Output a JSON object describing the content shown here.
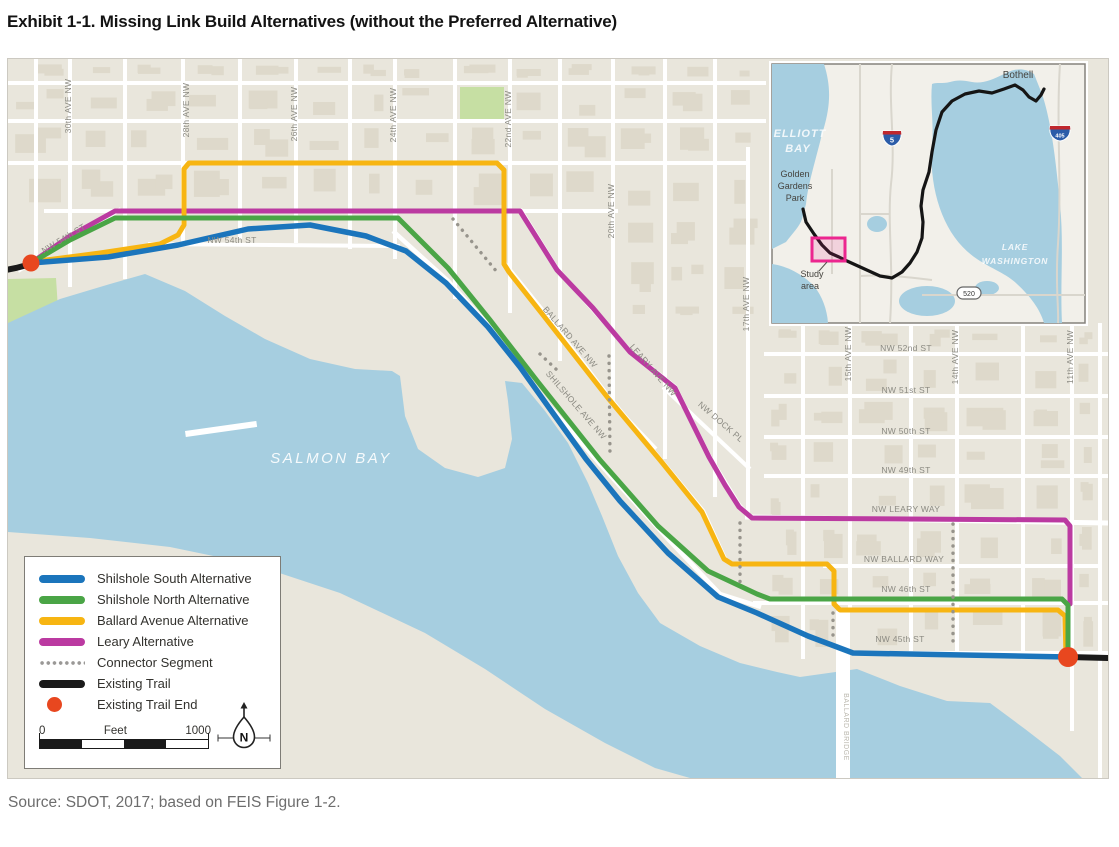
{
  "title": "Exhibit 1-1. Missing Link Build Alternatives (without the Preferred Alternative)",
  "source": "Source: SDOT, 2017; based on FEIS Figure 1-2.",
  "north_label": "N",
  "scale_bar": {
    "start": "0",
    "unit": "Feet",
    "end": "1000"
  },
  "legend": {
    "items": [
      {
        "label": "Shilshole South Alternative",
        "swatch": "line",
        "color": "#1b75bc"
      },
      {
        "label": "Shilshole North Alternative",
        "swatch": "line",
        "color": "#4aa546"
      },
      {
        "label": "Ballard Avenue Alternative",
        "swatch": "line",
        "color": "#f7b512"
      },
      {
        "label": "Leary Alternative",
        "swatch": "line",
        "color": "#bb3aa1"
      },
      {
        "label": "Connector Segment",
        "swatch": "dotted",
        "color": "#9a9896"
      },
      {
        "label": "Existing Trail",
        "swatch": "line",
        "color": "#1a1a1a"
      },
      {
        "label": "Existing Trail End",
        "swatch": "dot",
        "color": "#e8471f"
      }
    ]
  },
  "colors": {
    "water": "#a6cee0",
    "land": "#e9e6dc",
    "street": "#ffffff",
    "park": "#c6dfa3",
    "study_area_pink": "#ec268f",
    "route_blue": "#1b75bc",
    "route_green": "#4aa546",
    "route_yellow": "#f7b512",
    "route_magenta": "#bb3aa1",
    "trail_black": "#1a1a1a",
    "trail_end_red": "#e8471f"
  },
  "map": {
    "street_labels": [
      {
        "text": "30th AVE NW",
        "x": 63,
        "y": 47,
        "rot": -90
      },
      {
        "text": "28th AVE NW",
        "x": 181,
        "y": 51,
        "rot": -90
      },
      {
        "text": "26th AVE NW",
        "x": 289,
        "y": 55,
        "rot": -90
      },
      {
        "text": "24th AVE NW",
        "x": 388,
        "y": 56,
        "rot": -90
      },
      {
        "text": "22nd AVE NW",
        "x": 503,
        "y": 60,
        "rot": -90
      },
      {
        "text": "20th AVE NW",
        "x": 606,
        "y": 152,
        "rot": -90
      },
      {
        "text": "17th AVE NW",
        "x": 741,
        "y": 245,
        "rot": -90
      },
      {
        "text": "15th AVE NW",
        "x": 843,
        "y": 295,
        "rot": -90
      },
      {
        "text": "14th AVE NW",
        "x": 950,
        "y": 298,
        "rot": -90
      },
      {
        "text": "11th AVE NW",
        "x": 1065,
        "y": 298,
        "rot": -90
      },
      {
        "text": "NW 54th ST",
        "x": 57,
        "y": 182,
        "rot": -31
      },
      {
        "text": "NW 54th ST",
        "x": 224,
        "y": 184
      },
      {
        "text": "NW 52nd ST",
        "x": 898,
        "y": 292
      },
      {
        "text": "NW 51st ST",
        "x": 898,
        "y": 334
      },
      {
        "text": "NW 50th ST",
        "x": 898,
        "y": 375
      },
      {
        "text": "NW 49th ST",
        "x": 898,
        "y": 414
      },
      {
        "text": "NW LEARY WAY",
        "x": 898,
        "y": 453
      },
      {
        "text": "NW BALLARD WAY",
        "x": 896,
        "y": 503
      },
      {
        "text": "NW 46th ST",
        "x": 898,
        "y": 533
      },
      {
        "text": "NW 45th ST",
        "x": 892,
        "y": 583
      },
      {
        "text": "BALLARD AVE NW",
        "x": 560,
        "y": 280,
        "rot": 49
      },
      {
        "text": "LEARY AVE NW",
        "x": 643,
        "y": 313,
        "rot": 49
      },
      {
        "text": "SHILSHOLE AVE NW",
        "x": 566,
        "y": 348,
        "rot": 49
      },
      {
        "text": "NW DOCK PL",
        "x": 711,
        "y": 365,
        "rot": 41
      },
      {
        "text": "SALMON BAY",
        "x": 323,
        "y": 404,
        "cls": "water"
      },
      {
        "text": "BALLARD BRIDGE",
        "x": 836,
        "y": 668,
        "rot": 90,
        "cls": "bridge"
      }
    ]
  },
  "inset": {
    "labels": [
      {
        "text": "ELLIOTT",
        "x": 28,
        "y": 73,
        "cls": "il-wl"
      },
      {
        "text": "BAY",
        "x": 26,
        "y": 88,
        "cls": "il-wl"
      },
      {
        "text": "LAKE",
        "x": 243,
        "y": 186,
        "cls": "il-wls"
      },
      {
        "text": "WASHINGTON",
        "x": 243,
        "y": 200,
        "cls": "il-wls"
      },
      {
        "text": "Bothell",
        "x": 246,
        "y": 14,
        "cls": "il-pl"
      },
      {
        "text": "Golden",
        "x": 23,
        "y": 113,
        "cls": "il-pls"
      },
      {
        "text": "Gardens",
        "x": 23,
        "y": 125,
        "cls": "il-pls"
      },
      {
        "text": "Park",
        "x": 23,
        "y": 137,
        "cls": "il-pls"
      },
      {
        "text": "Study",
        "x": 40,
        "y": 213,
        "cls": "il-pls"
      },
      {
        "text": "area",
        "x": 38,
        "y": 225,
        "cls": "il-pls"
      }
    ],
    "shields": {
      "i5": "5",
      "i405": "405",
      "sr520": "520"
    }
  }
}
